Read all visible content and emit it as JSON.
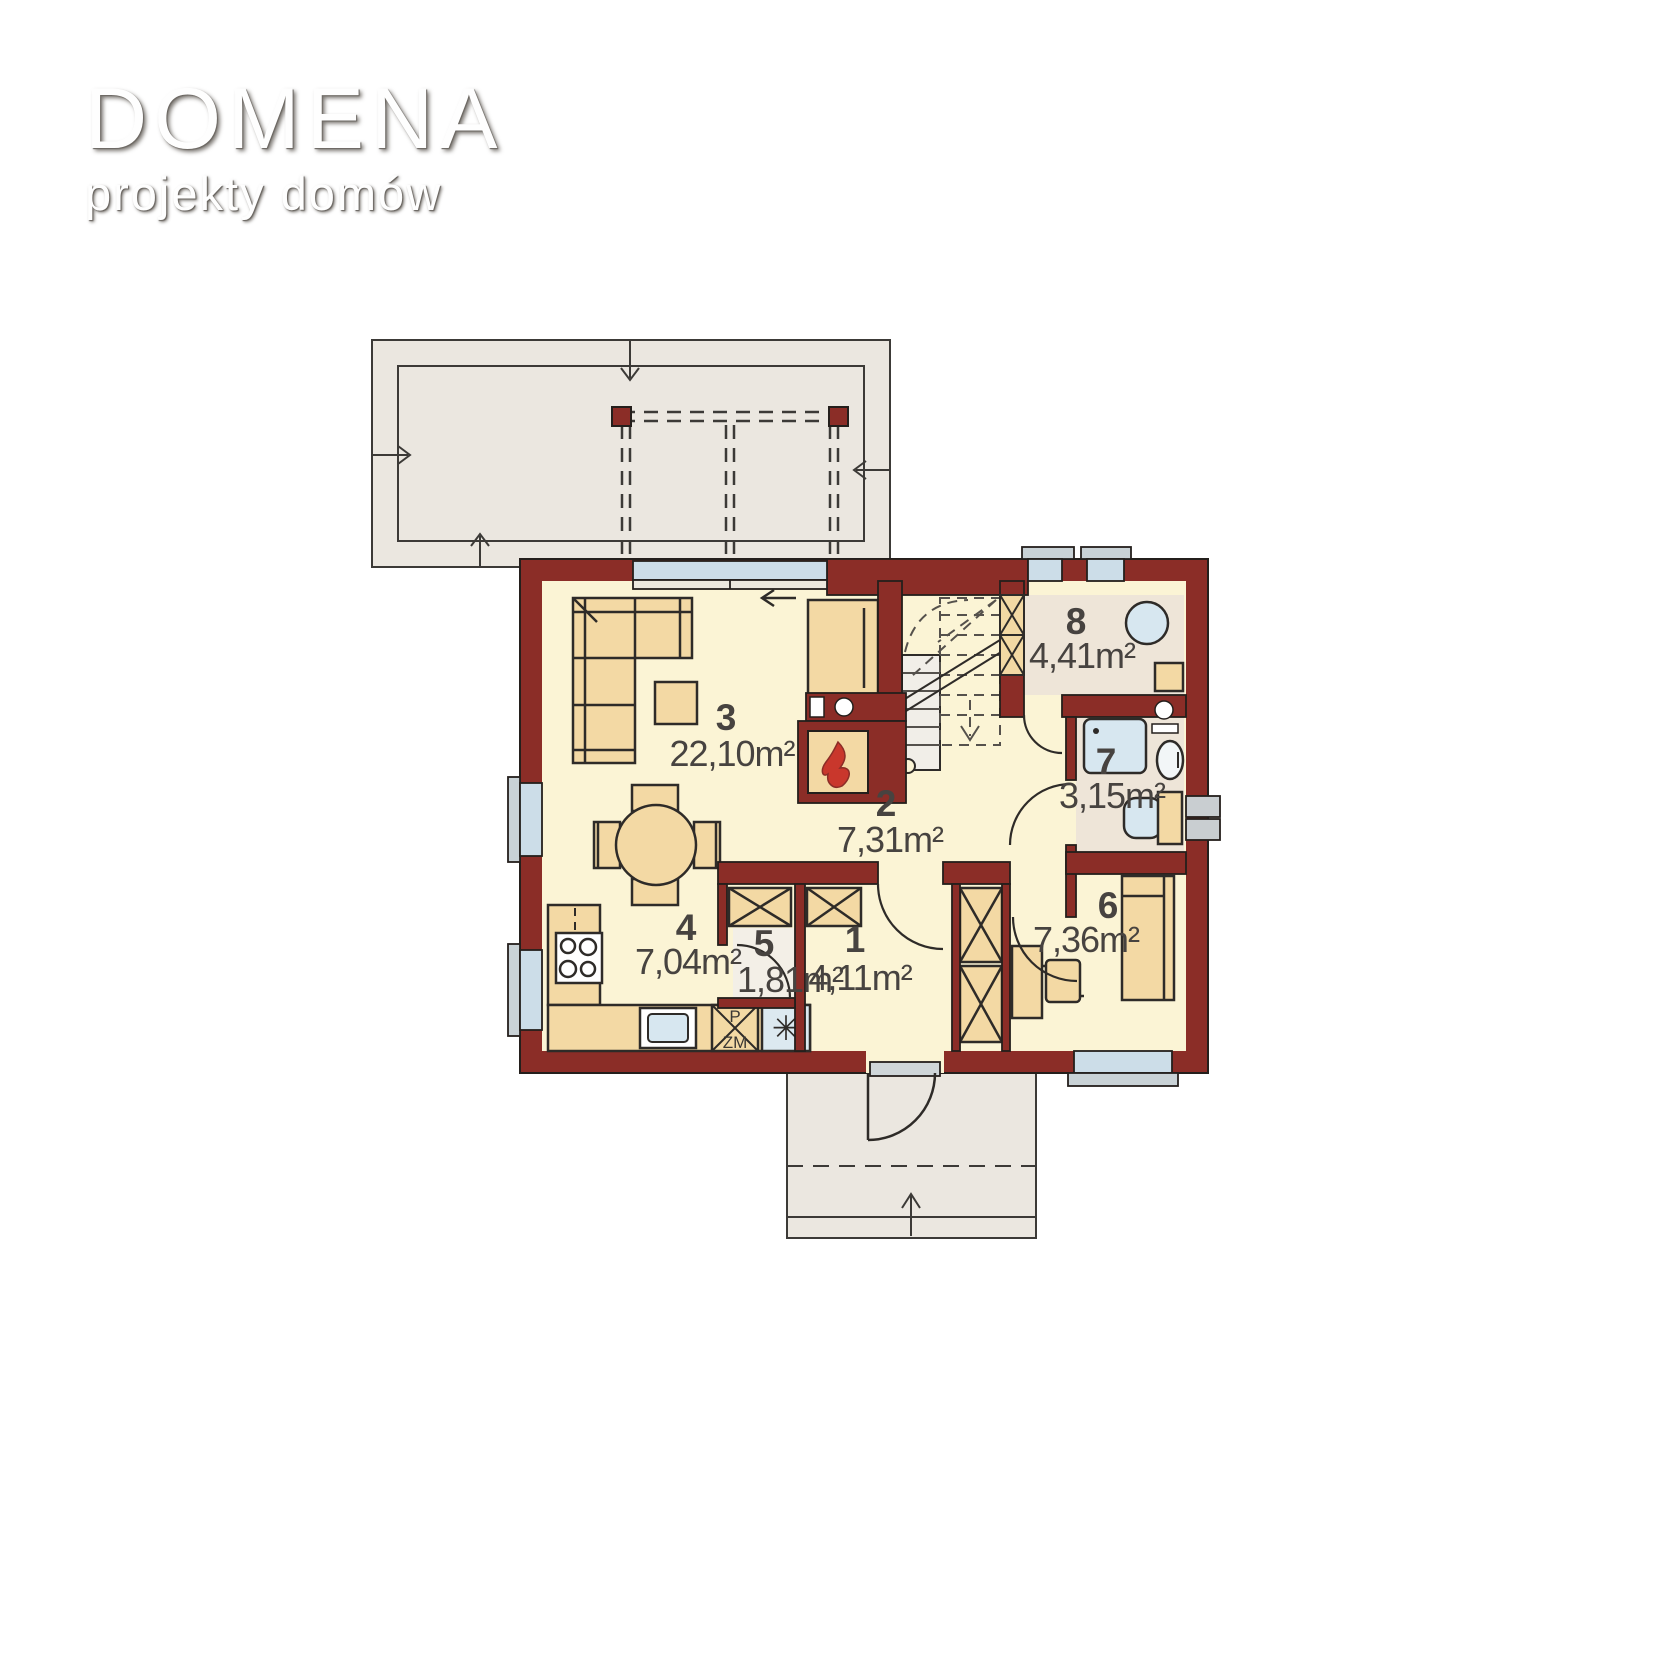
{
  "logo": {
    "title": "DOMENA",
    "subtitle": "projekty domów"
  },
  "plan": {
    "rooms": [
      {
        "number": "1",
        "area": "4,11m²"
      },
      {
        "number": "2",
        "area": "7,31m²"
      },
      {
        "number": "3",
        "area": "22,10m²"
      },
      {
        "number": "4",
        "area": "7,04m²"
      },
      {
        "number": "5",
        "area": "1,81m²"
      },
      {
        "number": "6",
        "area": "7,36m²"
      },
      {
        "number": "7",
        "area": "3,15m²"
      },
      {
        "number": "8",
        "area": "4,41m²"
      }
    ],
    "kitchen": {
      "appliance_label_top": "P",
      "appliance_label_bottom": "ZM",
      "fridge_icon": "✳"
    },
    "colors": {
      "wall": "#8b2d27",
      "floor_main": "#fbf4d5",
      "floor_secondary": "#eee5d8",
      "furniture": "#f3d9a4",
      "glazing": "#ccdde8",
      "fixture_blue": "#d7e7f0",
      "outdoor": "#ebe7e0"
    }
  }
}
